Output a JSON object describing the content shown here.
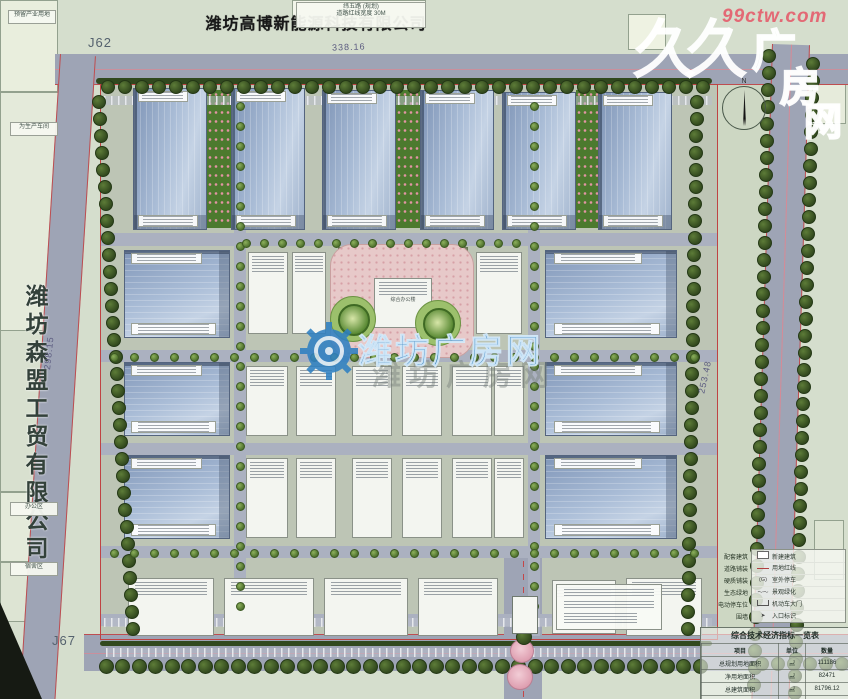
{
  "title": {
    "text": "潍坊高博新能源科技有限公司"
  },
  "left_company": {
    "text": "潍坊森盟工贸有限公司"
  },
  "corner_labels": {
    "top_left": "J62",
    "bottom_left": "J67"
  },
  "dimensions": {
    "top": "338.16",
    "left": "298.15",
    "right": "253.48"
  },
  "right_road_name": {
    "chars": [
      "海",
      "港",
      "大",
      "道"
    ],
    "ys": [
      168,
      252,
      386,
      468
    ]
  },
  "north": {
    "label": "N"
  },
  "watermark": {
    "site_red": "99ctw.com",
    "logo_big": "久久",
    "logo_outline": [
      "广",
      "房",
      "网"
    ],
    "center_text": "潍坊广房网",
    "center_echo": "潍坊广房网",
    "brand_blue": "#2f80c2",
    "brand_red": "#e45c6c"
  },
  "micro_labels": {
    "top_box_lines": [
      "纬五路 (规划)",
      "道路红线宽度 30M"
    ],
    "left_parcel_top": "预留产业用地",
    "left_parcel_mid": "为生产车间",
    "left_parcel_a": "办公区",
    "left_parcel_b": "宿舍区",
    "plaza_building": "综合办公楼"
  },
  "legend": {
    "left_items": [
      "配套建筑",
      "道路铺装",
      "硬质铺装",
      "生态绿地",
      "电动停车位",
      "围墙"
    ],
    "items": [
      {
        "symbol": "rect",
        "label": "新建建筑"
      },
      {
        "symbol": "line",
        "label": "用地红线"
      },
      {
        "symbol": "(G)",
        "label": "室外停车"
      },
      {
        "symbol": "wave",
        "label": "景观绿化"
      },
      {
        "symbol": "gate",
        "label": "机动车大门"
      },
      {
        "symbol": "arrow",
        "label": "入口标识"
      }
    ]
  },
  "table": {
    "title": "综合技术经济指标一览表",
    "headers": [
      "项目",
      "单位",
      "数量"
    ],
    "rows": [
      [
        "总规划用地面积",
        "㎡",
        "111186"
      ],
      [
        "净用地面积",
        "㎡",
        "82471"
      ],
      [
        "总建筑面积",
        "㎡",
        "81796.12"
      ],
      [
        "地上建筑面积",
        "㎡",
        "81529.48"
      ]
    ]
  },
  "scene": {
    "parcels": [
      {
        "x": 0,
        "y": 0,
        "w": 848,
        "h": 699,
        "c": "#d5decd"
      },
      {
        "x": 0,
        "y": 0,
        "w": 58,
        "h": 92,
        "c": "#e9eedd",
        "b": 1
      },
      {
        "x": 0,
        "y": 92,
        "w": 60,
        "h": 240,
        "c": "#e4eada",
        "b": 1
      },
      {
        "x": 0,
        "y": 330,
        "w": 60,
        "h": 162,
        "c": "#d8e0cf",
        "b": 1
      },
      {
        "x": 0,
        "y": 492,
        "w": 60,
        "h": 70,
        "c": "#e4eada",
        "b": 1
      },
      {
        "x": 0,
        "y": 562,
        "w": 60,
        "h": 60,
        "c": "#dde4d3",
        "b": 1
      },
      {
        "x": 292,
        "y": 0,
        "w": 134,
        "h": 28,
        "c": "#f2f5ea",
        "b": 1
      },
      {
        "x": 628,
        "y": 14,
        "w": 38,
        "h": 36,
        "c": "#eef2e2",
        "b": 1
      },
      {
        "x": 812,
        "y": 58,
        "w": 34,
        "h": 66,
        "c": "#e6ebdb",
        "b": 1
      },
      {
        "x": 814,
        "y": 520,
        "w": 30,
        "h": 60,
        "c": "#dde4d3",
        "b": 1
      },
      {
        "x": 100,
        "y": 84,
        "w": 618,
        "h": 556,
        "c": "#bdc5b5"
      },
      {
        "x": 718,
        "y": 84,
        "w": 56,
        "h": 560,
        "c": "#cdd7c3"
      }
    ],
    "roads": [
      {
        "x": 55,
        "y": 54,
        "w": 793,
        "h": 30,
        "edges": "b",
        "center": "h"
      },
      {
        "x": 60,
        "y": 54,
        "w": 34,
        "h": 660,
        "rot": 3.6,
        "edges": "lr"
      },
      {
        "x": 772,
        "y": 44,
        "w": 36,
        "h": 655,
        "rot": 1.8,
        "edges": "lr",
        "center": "v"
      },
      {
        "x": 84,
        "y": 634,
        "w": 764,
        "h": 36,
        "edges": "t",
        "center": "h"
      },
      {
        "x": 504,
        "y": 548,
        "w": 38,
        "h": 151,
        "center": "vd"
      }
    ],
    "iroads": [
      {
        "x": 100,
        "y": 233,
        "w": 618,
        "h": 13
      },
      {
        "x": 100,
        "y": 350,
        "w": 618,
        "h": 12
      },
      {
        "x": 100,
        "y": 443,
        "w": 618,
        "h": 12
      },
      {
        "x": 100,
        "y": 546,
        "w": 618,
        "h": 12
      },
      {
        "x": 234,
        "y": 96,
        "w": 12,
        "h": 540
      },
      {
        "x": 528,
        "y": 96,
        "w": 12,
        "h": 540
      },
      {
        "x": 100,
        "y": 614,
        "w": 618,
        "h": 12
      }
    ],
    "strips": [
      {
        "x": 96,
        "y": 78,
        "w": 616,
        "h": 6,
        "k": "hedge"
      },
      {
        "x": 100,
        "y": 641,
        "w": 612,
        "h": 5,
        "k": "hedge"
      },
      {
        "x": 207,
        "y": 90,
        "w": 24,
        "h": 138,
        "k": "flower"
      },
      {
        "x": 396,
        "y": 90,
        "w": 24,
        "h": 138,
        "k": "flower"
      },
      {
        "x": 576,
        "y": 90,
        "w": 22,
        "h": 138,
        "k": "flower"
      },
      {
        "x": 104,
        "y": 96,
        "w": 608,
        "h": 9,
        "k": "comb"
      },
      {
        "x": 104,
        "y": 618,
        "w": 608,
        "h": 9,
        "k": "comb"
      },
      {
        "x": 106,
        "y": 648,
        "w": 596,
        "h": 9,
        "k": "comb"
      },
      {
        "x": 338,
        "y": 247,
        "w": 128,
        "h": 14,
        "k": "pergola"
      }
    ],
    "boundary": {
      "x": 100,
      "y": 84,
      "w": 618,
      "h": 556
    },
    "plaza": {
      "x": 330,
      "y": 244,
      "w": 142,
      "h": 112
    },
    "buildings": {
      "top": [
        {
          "x": 133,
          "y": 88,
          "w": 74,
          "h": 142
        },
        {
          "x": 231,
          "y": 88,
          "w": 74,
          "h": 142
        },
        {
          "x": 322,
          "y": 90,
          "w": 74,
          "h": 140
        },
        {
          "x": 420,
          "y": 90,
          "w": 74,
          "h": 140
        },
        {
          "x": 502,
          "y": 92,
          "w": 74,
          "h": 138
        },
        {
          "x": 598,
          "y": 92,
          "w": 74,
          "h": 138
        }
      ],
      "left": [
        {
          "x": 124,
          "y": 250,
          "w": 106,
          "h": 88
        },
        {
          "x": 124,
          "y": 362,
          "w": 106,
          "h": 74
        },
        {
          "x": 124,
          "y": 455,
          "w": 106,
          "h": 84
        }
      ],
      "right": [
        {
          "x": 545,
          "y": 250,
          "w": 132,
          "h": 88
        },
        {
          "x": 545,
          "y": 362,
          "w": 132,
          "h": 74
        },
        {
          "x": 545,
          "y": 455,
          "w": 132,
          "h": 84
        }
      ],
      "white": [
        {
          "x": 248,
          "y": 252,
          "w": 40,
          "h": 82
        },
        {
          "x": 292,
          "y": 252,
          "w": 34,
          "h": 82
        },
        {
          "x": 476,
          "y": 252,
          "w": 46,
          "h": 82
        },
        {
          "x": 246,
          "y": 366,
          "w": 42,
          "h": 70
        },
        {
          "x": 296,
          "y": 366,
          "w": 40,
          "h": 70
        },
        {
          "x": 352,
          "y": 366,
          "w": 40,
          "h": 70
        },
        {
          "x": 402,
          "y": 366,
          "w": 40,
          "h": 70
        },
        {
          "x": 452,
          "y": 366,
          "w": 40,
          "h": 70
        },
        {
          "x": 494,
          "y": 366,
          "w": 30,
          "h": 70
        },
        {
          "x": 246,
          "y": 458,
          "w": 42,
          "h": 80
        },
        {
          "x": 296,
          "y": 458,
          "w": 40,
          "h": 80
        },
        {
          "x": 352,
          "y": 458,
          "w": 40,
          "h": 80
        },
        {
          "x": 402,
          "y": 458,
          "w": 40,
          "h": 80
        },
        {
          "x": 452,
          "y": 458,
          "w": 40,
          "h": 80
        },
        {
          "x": 494,
          "y": 458,
          "w": 30,
          "h": 80
        },
        {
          "x": 128,
          "y": 578,
          "w": 86,
          "h": 58
        },
        {
          "x": 224,
          "y": 578,
          "w": 90,
          "h": 58
        },
        {
          "x": 324,
          "y": 578,
          "w": 84,
          "h": 58
        },
        {
          "x": 418,
          "y": 578,
          "w": 80,
          "h": 58
        },
        {
          "x": 552,
          "y": 580,
          "w": 64,
          "h": 54
        },
        {
          "x": 626,
          "y": 578,
          "w": 76,
          "h": 58
        },
        {
          "x": 374,
          "y": 278,
          "w": 58,
          "h": 50
        }
      ]
    },
    "treeRows": [
      {
        "x": 108,
        "y": 87,
        "n": 36,
        "dx": 17,
        "dy": 0,
        "r": 7,
        "sm": 0
      },
      {
        "x": 99,
        "y": 102,
        "n": 32,
        "dx": 1.1,
        "dy": 17,
        "r": 7,
        "sm": 0
      },
      {
        "x": 697,
        "y": 102,
        "n": 32,
        "dx": -0.3,
        "dy": 17,
        "r": 7,
        "sm": 0
      },
      {
        "x": 769,
        "y": 56,
        "n": 38,
        "dx": -0.4,
        "dy": 17,
        "r": 7,
        "sm": 0
      },
      {
        "x": 813,
        "y": 64,
        "n": 38,
        "dx": -0.5,
        "dy": 17,
        "r": 7,
        "sm": 0
      },
      {
        "x": 106,
        "y": 666,
        "n": 37,
        "dx": 16.5,
        "dy": 0,
        "r": 7.5,
        "sm": 0
      },
      {
        "x": 762,
        "y": 664,
        "n": 6,
        "dx": 16,
        "dy": 0,
        "r": 7,
        "sm": 0
      },
      {
        "x": 240,
        "y": 106,
        "n": 26,
        "dx": 0,
        "dy": 20,
        "r": 4.5,
        "sm": 1
      },
      {
        "x": 534,
        "y": 106,
        "n": 26,
        "dx": 0,
        "dy": 20,
        "r": 4.5,
        "sm": 1
      },
      {
        "x": 114,
        "y": 357,
        "n": 30,
        "dx": 20,
        "dy": 0,
        "r": 4.5,
        "sm": 1
      },
      {
        "x": 114,
        "y": 553,
        "n": 30,
        "dx": 20,
        "dy": 0,
        "r": 4.5,
        "sm": 1
      },
      {
        "x": 246,
        "y": 243,
        "n": 16,
        "dx": 18,
        "dy": 0,
        "r": 4.5,
        "sm": 1
      }
    ],
    "circles": [
      {
        "x": 352,
        "y": 318,
        "r": 22,
        "cls": "lawn"
      },
      {
        "x": 437,
        "y": 322,
        "r": 22,
        "cls": "lawn"
      },
      {
        "x": 352,
        "y": 318,
        "r": 14,
        "cls": "ptree"
      },
      {
        "x": 437,
        "y": 322,
        "r": 14,
        "cls": "ptree"
      },
      {
        "x": 521,
        "y": 650,
        "r": 11,
        "cls": "pink"
      },
      {
        "x": 519,
        "y": 676,
        "r": 12,
        "cls": "pink"
      },
      {
        "x": 524,
        "y": 637,
        "r": 8,
        "cls": "tree"
      }
    ]
  }
}
